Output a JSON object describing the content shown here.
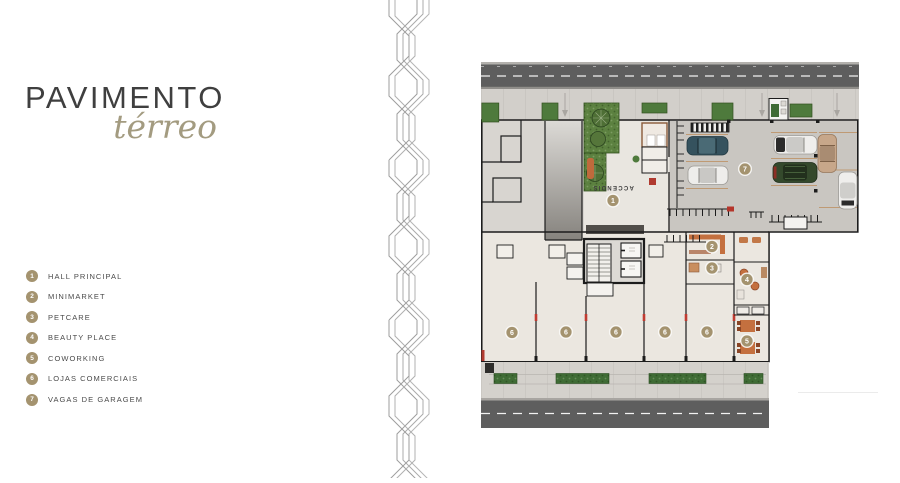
{
  "header": {
    "title": "PAVIMENTO",
    "subtitle": "térreo"
  },
  "legend": {
    "items": [
      {
        "number": "1",
        "label": "HALL PRINCIPAL"
      },
      {
        "number": "2",
        "label": "MINIMARKET"
      },
      {
        "number": "3",
        "label": "PETCARE"
      },
      {
        "number": "4",
        "label": "BEAUTY PLACE"
      },
      {
        "number": "5",
        "label": "COWORKING"
      },
      {
        "number": "6",
        "label": "LOJAS COMERCIAIS"
      },
      {
        "number": "7",
        "label": "VAGAS DE GARAGEM"
      }
    ]
  },
  "plan": {
    "hall_label": "ACCENDIS",
    "badges": [
      {
        "number": "1"
      },
      {
        "number": "2"
      },
      {
        "number": "3"
      },
      {
        "number": "4"
      },
      {
        "number": "5"
      },
      {
        "number": "6"
      },
      {
        "number": "6"
      },
      {
        "number": "6"
      },
      {
        "number": "6"
      },
      {
        "number": "6"
      },
      {
        "number": "7"
      }
    ]
  },
  "colors": {
    "badge-bg": "#a4936f",
    "accent-subtitle": "#a39b80",
    "title": "#3f3f3f",
    "legend-text": "#4a4a4a",
    "wall": "#1c1c1c",
    "road": "#5e5e5e",
    "floor-upper": "#cac7c2",
    "floor-stores": "#ebe7e0",
    "garden": "#5c8140",
    "hedge": "#3f6c35",
    "pattern-line": "#a3a3a3"
  }
}
